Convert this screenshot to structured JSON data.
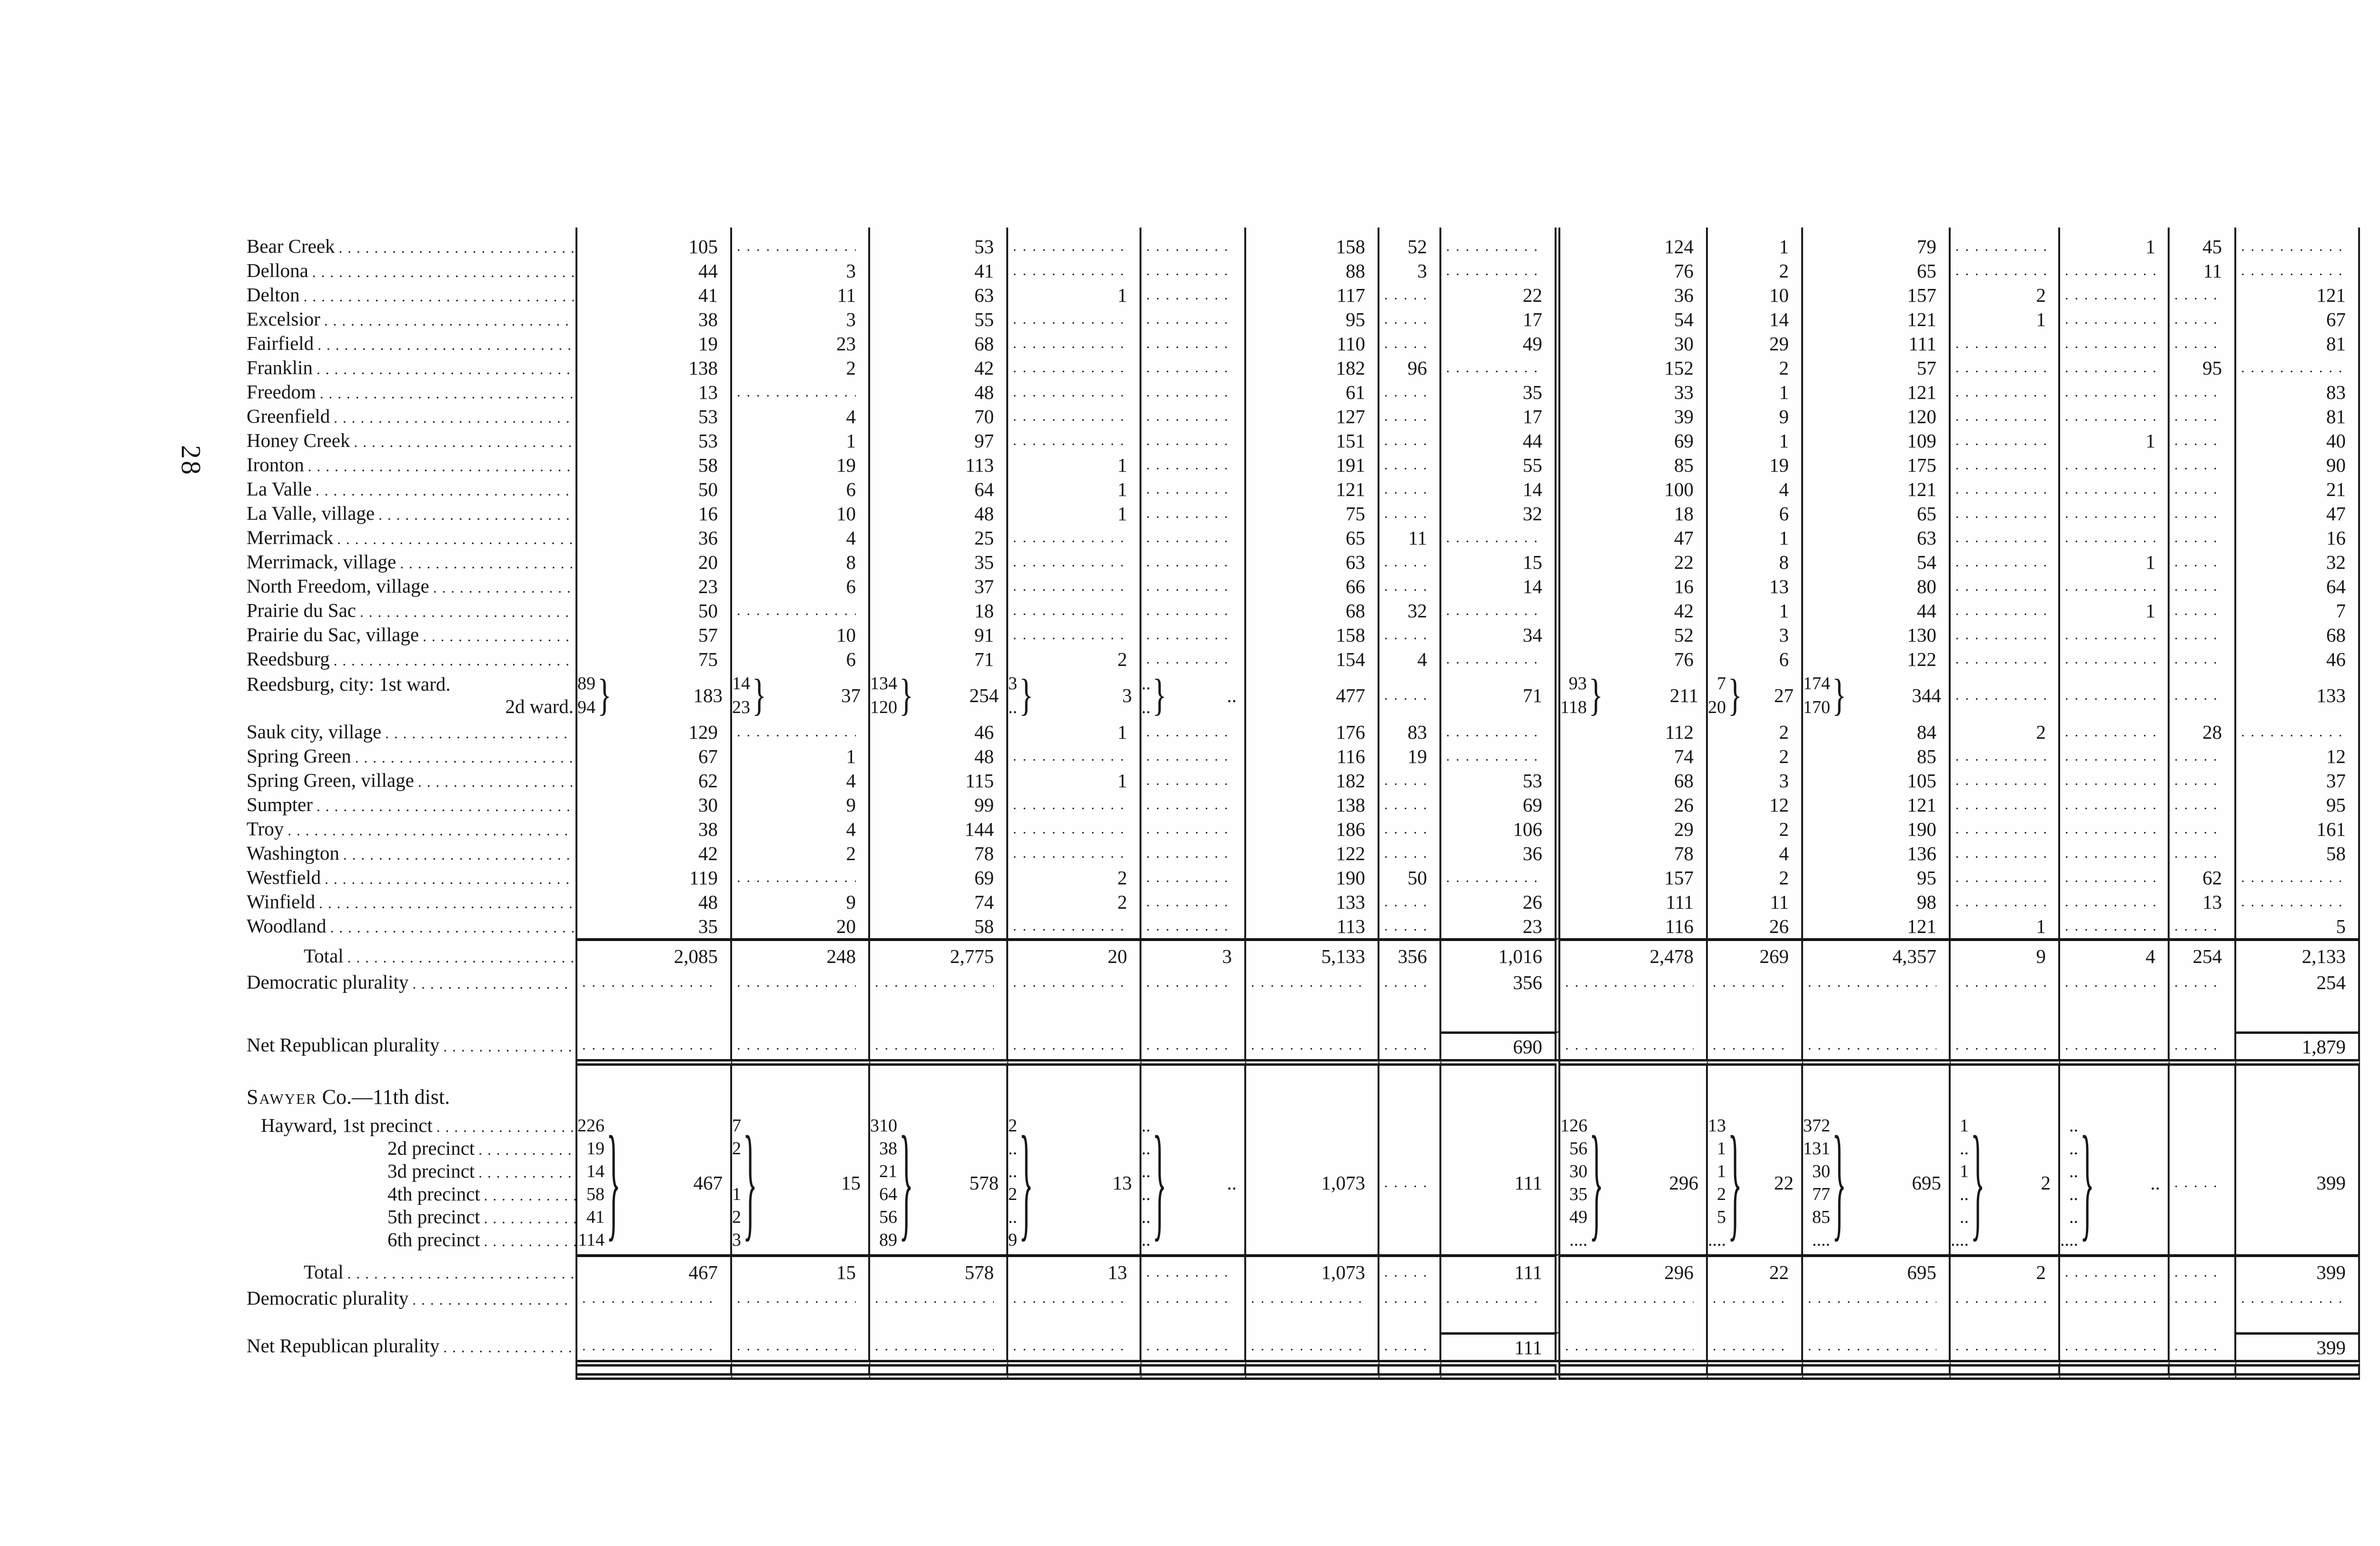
{
  "page": {
    "margin_left_number": "28",
    "running_head": "ELECTION STATISTICS.",
    "page_number": "433"
  },
  "labels": {
    "total": "Total",
    "dem": "Democratic plurality",
    "net": "Net Republican plurality"
  },
  "sauk": {
    "rows": [
      {
        "label": "Bear Creek",
        "cells": [
          "105",
          "D",
          "53",
          "D",
          "D",
          "158",
          "52",
          "D",
          "124",
          "1",
          "79",
          "D",
          "1",
          "45",
          "D"
        ]
      },
      {
        "label": "Dellona",
        "cells": [
          "44",
          "3",
          "41",
          "D",
          "D",
          "88",
          "3",
          "D",
          "76",
          "2",
          "65",
          "D",
          "D",
          "11",
          "D"
        ]
      },
      {
        "label": "Delton",
        "cells": [
          "41",
          "11",
          "63",
          "1",
          "D",
          "117",
          "D",
          "22",
          "36",
          "10",
          "157",
          "2",
          "D",
          "D",
          "121"
        ]
      },
      {
        "label": "Excelsior",
        "cells": [
          "38",
          "3",
          "55",
          "D",
          "D",
          "95",
          "D",
          "17",
          "54",
          "14",
          "121",
          "1",
          "D",
          "D",
          "67"
        ]
      },
      {
        "label": "Fairfield",
        "cells": [
          "19",
          "23",
          "68",
          "D",
          "D",
          "110",
          "D",
          "49",
          "30",
          "29",
          "111",
          "D",
          "D",
          "D",
          "81"
        ]
      },
      {
        "label": "Franklin",
        "cells": [
          "138",
          "2",
          "42",
          "D",
          "D",
          "182",
          "96",
          "D",
          "152",
          "2",
          "57",
          "D",
          "D",
          "95",
          "D"
        ]
      },
      {
        "label": "Freedom",
        "cells": [
          "13",
          "D",
          "48",
          "D",
          "D",
          "61",
          "D",
          "35",
          "33",
          "1",
          "121",
          "D",
          "D",
          "D",
          "83"
        ]
      },
      {
        "label": "Greenfield",
        "cells": [
          "53",
          "4",
          "70",
          "D",
          "D",
          "127",
          "D",
          "17",
          "39",
          "9",
          "120",
          "D",
          "D",
          "D",
          "81"
        ]
      },
      {
        "label": "Honey Creek",
        "cells": [
          "53",
          "1",
          "97",
          "D",
          "D",
          "151",
          "D",
          "44",
          "69",
          "1",
          "109",
          "D",
          "1",
          "D",
          "40"
        ]
      },
      {
        "label": "Ironton",
        "cells": [
          "58",
          "19",
          "113",
          "1",
          "D",
          "191",
          "D",
          "55",
          "85",
          "19",
          "175",
          "D",
          "D",
          "D",
          "90"
        ]
      },
      {
        "label": "La Valle",
        "cells": [
          "50",
          "6",
          "64",
          "1",
          "D",
          "121",
          "D",
          "14",
          "100",
          "4",
          "121",
          "D",
          "D",
          "D",
          "21"
        ]
      },
      {
        "label": "La Valle, village",
        "cells": [
          "16",
          "10",
          "48",
          "1",
          "D",
          "75",
          "D",
          "32",
          "18",
          "6",
          "65",
          "D",
          "D",
          "D",
          "47"
        ]
      },
      {
        "label": "Merrimack",
        "cells": [
          "36",
          "4",
          "25",
          "D",
          "D",
          "65",
          "11",
          "D",
          "47",
          "1",
          "63",
          "D",
          "D",
          "D",
          "16"
        ]
      },
      {
        "label": "Merrimack, village",
        "cells": [
          "20",
          "8",
          "35",
          "D",
          "D",
          "63",
          "D",
          "15",
          "22",
          "8",
          "54",
          "D",
          "1",
          "D",
          "32"
        ]
      },
      {
        "label": "North Freedom, village",
        "cells": [
          "23",
          "6",
          "37",
          "D",
          "D",
          "66",
          "D",
          "14",
          "16",
          "13",
          "80",
          "D",
          "D",
          "D",
          "64"
        ]
      },
      {
        "label": "Prairie du Sac",
        "cells": [
          "50",
          "D",
          "18",
          "D",
          "D",
          "68",
          "32",
          "D",
          "42",
          "1",
          "44",
          "D",
          "1",
          "D",
          "7"
        ]
      },
      {
        "label": "Prairie du Sac, village",
        "cells": [
          "57",
          "10",
          "91",
          "D",
          "D",
          "158",
          "D",
          "34",
          "52",
          "3",
          "130",
          "D",
          "D",
          "D",
          "68"
        ]
      },
      {
        "label": "Reedsburg",
        "cells": [
          "75",
          "6",
          "71",
          "2",
          "D",
          "154",
          "4",
          "D",
          "76",
          "6",
          "122",
          "D",
          "D",
          "D",
          "46"
        ]
      },
      {
        "label": "Reedsburg, city: 1st ward.",
        "label2": "2d ward.",
        "cells": [
          {
            "sub": [
              "89",
              "94"
            ],
            "main": "183"
          },
          {
            "sub": [
              "14",
              "23"
            ],
            "main": "37"
          },
          {
            "sub": [
              "134",
              "120"
            ],
            "main": "254"
          },
          {
            "sub": [
              "3",
              ".."
            ],
            "main": "3"
          },
          {
            "sub": [
              "..",
              ".."
            ],
            "main": ".."
          },
          "477",
          "D",
          "71",
          {
            "sub": [
              "93",
              "118"
            ],
            "main": "211"
          },
          {
            "sub": [
              "7",
              "20"
            ],
            "main": "27"
          },
          {
            "sub": [
              "174",
              "170"
            ],
            "main": "344"
          },
          "D",
          "D",
          "D",
          "133"
        ]
      },
      {
        "label": "Sauk city, village",
        "cells": [
          "129",
          "D",
          "46",
          "1",
          "D",
          "176",
          "83",
          "D",
          "112",
          "2",
          "84",
          "2",
          "D",
          "28",
          "D"
        ]
      },
      {
        "label": "Spring Green",
        "cells": [
          "67",
          "1",
          "48",
          "D",
          "D",
          "116",
          "19",
          "D",
          "74",
          "2",
          "85",
          "D",
          "D",
          "D",
          "12"
        ]
      },
      {
        "label": "Spring Green, village",
        "cells": [
          "62",
          "4",
          "115",
          "1",
          "D",
          "182",
          "D",
          "53",
          "68",
          "3",
          "105",
          "D",
          "D",
          "D",
          "37"
        ]
      },
      {
        "label": "Sumpter",
        "cells": [
          "30",
          "9",
          "99",
          "D",
          "D",
          "138",
          "D",
          "69",
          "26",
          "12",
          "121",
          "D",
          "D",
          "D",
          "95"
        ]
      },
      {
        "label": "Troy",
        "cells": [
          "38",
          "4",
          "144",
          "D",
          "D",
          "186",
          "D",
          "106",
          "29",
          "2",
          "190",
          "D",
          "D",
          "D",
          "161"
        ]
      },
      {
        "label": "Washington",
        "cells": [
          "42",
          "2",
          "78",
          "D",
          "D",
          "122",
          "D",
          "36",
          "78",
          "4",
          "136",
          "D",
          "D",
          "D",
          "58"
        ]
      },
      {
        "label": "Westfield",
        "cells": [
          "119",
          "D",
          "69",
          "2",
          "D",
          "190",
          "50",
          "D",
          "157",
          "2",
          "95",
          "D",
          "D",
          "62",
          "D"
        ]
      },
      {
        "label": "Winfield",
        "cells": [
          "48",
          "9",
          "74",
          "2",
          "D",
          "133",
          "D",
          "26",
          "111",
          "11",
          "98",
          "D",
          "D",
          "13",
          "D"
        ]
      },
      {
        "label": "Woodland",
        "cells": [
          "35",
          "20",
          "58",
          "D",
          "D",
          "113",
          "D",
          "23",
          "116",
          "26",
          "121",
          "1",
          "D",
          "D",
          "5"
        ]
      }
    ],
    "total": [
      "2,085",
      "248",
      "2,775",
      "20",
      "3",
      "5,133",
      "356",
      "1,016",
      "2,478",
      "269",
      "4,357",
      "9",
      "4",
      "254",
      "2,133"
    ],
    "dem": [
      "D",
      "D",
      "D",
      "D",
      "D",
      "D",
      "D",
      "356",
      "D",
      "D",
      "D",
      "D",
      "D",
      "D",
      "254"
    ],
    "net": [
      "D",
      "D",
      "D",
      "D",
      "D",
      "D",
      "D",
      "690",
      "D",
      "D",
      "D",
      "D",
      "D",
      "D",
      "1,879"
    ]
  },
  "sawyer": {
    "header_caps": "Sawyer",
    "header_rest": " Co.—11th dist.",
    "precincts": [
      "Hayward, 1st precinct",
      "2d precinct",
      "3d precinct",
      "4th precinct",
      "5th precinct",
      "6th precinct"
    ],
    "cells": [
      {
        "sub": [
          "226",
          "19",
          "14",
          "58",
          "41",
          "114"
        ],
        "main": "467"
      },
      {
        "sub": [
          "7",
          "2",
          "",
          "1",
          "2",
          "3"
        ],
        "main": "15"
      },
      {
        "sub": [
          "310",
          "38",
          "21",
          "64",
          "56",
          "89"
        ],
        "main": "578"
      },
      {
        "sub": [
          "2",
          "..",
          "..",
          "2",
          "..",
          "9"
        ],
        "main": "13"
      },
      {
        "sub": [
          "..",
          "..",
          "..",
          "..",
          "..",
          ".."
        ],
        "main": ".."
      },
      "1,073",
      "D",
      "111",
      {
        "sub": [
          "126",
          "56",
          "30",
          "35",
          "49",
          "...."
        ],
        "main": "296"
      },
      {
        "sub": [
          "13",
          "1",
          "1",
          "2",
          "5",
          "...."
        ],
        "main": "22"
      },
      {
        "sub": [
          "372",
          "131",
          "30",
          "77",
          "85",
          "...."
        ],
        "main": "695"
      },
      {
        "sub": [
          "1",
          "..",
          "1",
          "..",
          "..",
          "...."
        ],
        "main": "2"
      },
      {
        "sub": [
          "..",
          "..",
          "..",
          "..",
          "..",
          "...."
        ],
        "main": ".."
      },
      "D",
      "399"
    ],
    "total": [
      "467",
      "15",
      "578",
      "13",
      "D",
      "1,073",
      "D",
      "111",
      "296",
      "22",
      "695",
      "2",
      "D",
      "D",
      "399"
    ],
    "dem": [
      "D",
      "D",
      "D",
      "D",
      "D",
      "D",
      "D",
      "D",
      "D",
      "D",
      "D",
      "D",
      "D",
      "D",
      "D"
    ],
    "net": [
      "D",
      "D",
      "D",
      "D",
      "D",
      "D",
      "D",
      "111",
      "D",
      "D",
      "D",
      "D",
      "D",
      "D",
      "399"
    ]
  }
}
